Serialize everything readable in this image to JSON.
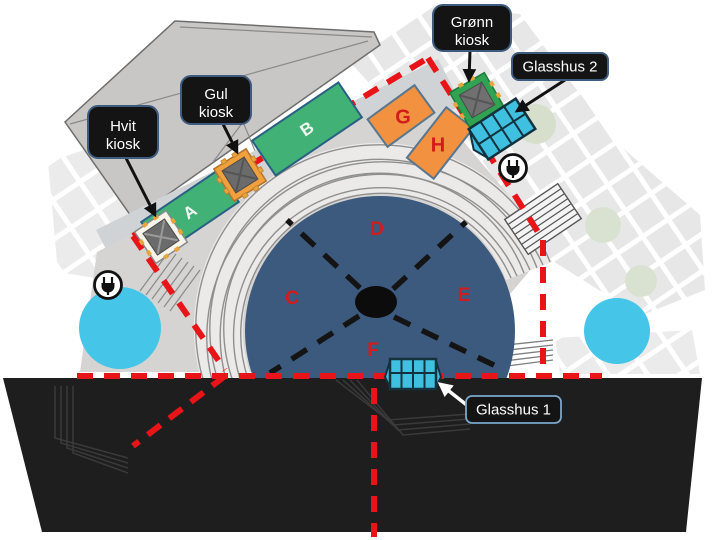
{
  "map": {
    "callouts": {
      "hvit": {
        "line1": "Hvit",
        "line2": "kiosk"
      },
      "gul": {
        "line1": "Gul",
        "line2": "kiosk"
      },
      "gronn": {
        "line1": "Grønn",
        "line2": "kiosk"
      },
      "glasshus2": {
        "label": "Glasshus 2"
      },
      "glasshus1": {
        "label": "Glasshus 1"
      }
    },
    "zones": {
      "a": "A",
      "b": "B",
      "c": "C",
      "d": "D",
      "e": "E",
      "f": "F",
      "g": "G",
      "h": "H"
    },
    "icons": {
      "power": "power-plug-icon",
      "kiosk": "kiosk-marker",
      "glasshouse": "glasshouse-marker"
    },
    "colors": {
      "boundary_red": "#e81417",
      "zone_green": "#41b175",
      "zone_orange": "#f2913f",
      "arena_blue": "#3c5a7e",
      "glass_cyan": "#3fc0e0",
      "tree_cyan": "#45c5e8",
      "foliage_green": "#d5dfcc",
      "stage_black": "#1e1e1e",
      "building_gray": "#c9c7c5",
      "plaza_gray": "#d6d4d2",
      "label_bg": "#141414",
      "label_border": "#3e5c80"
    }
  }
}
